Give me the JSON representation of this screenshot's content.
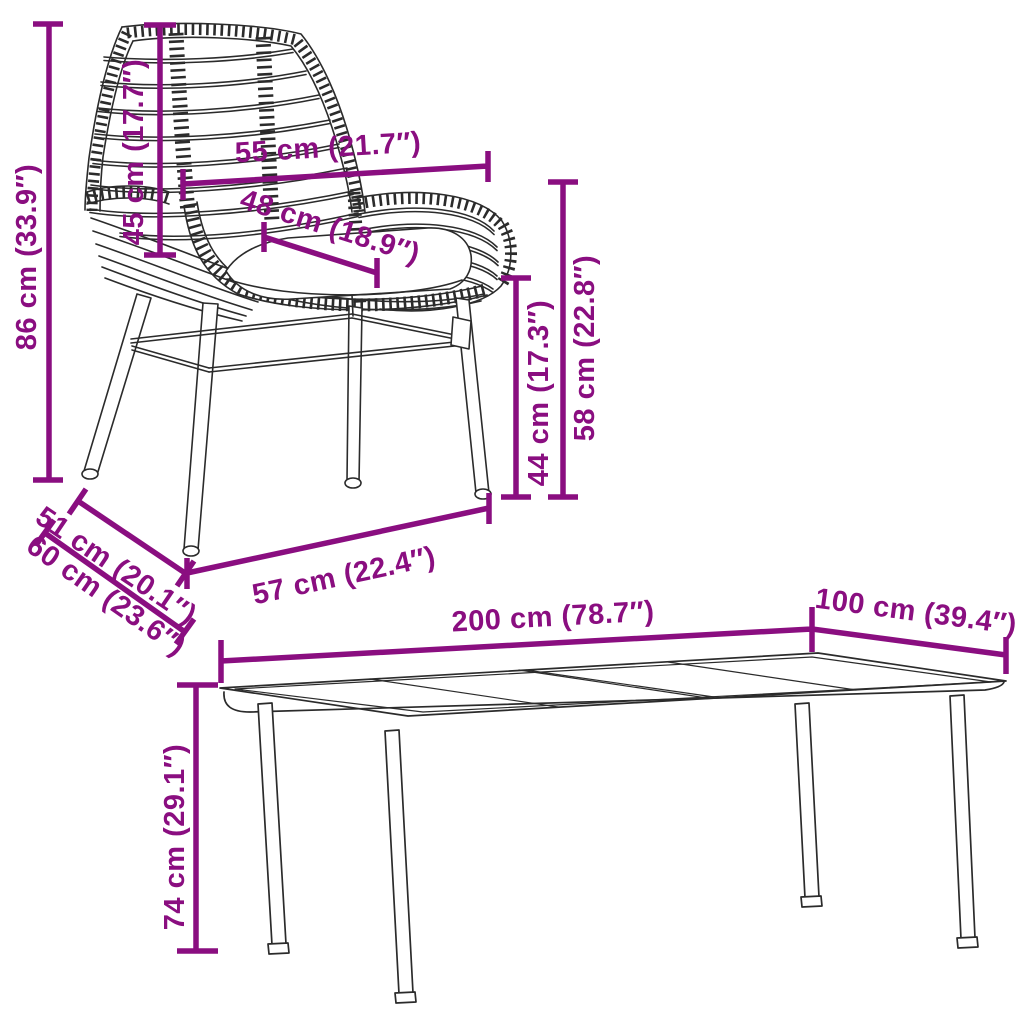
{
  "page": {
    "background": "#ffffff"
  },
  "colors": {
    "dimension_accent": "#8a0e80",
    "line_art": "#2b2b2b"
  },
  "chair": {
    "dims": {
      "total_height": "86 cm (33.9″)",
      "backrest_height": "45 cm (17.7″)",
      "back_width": "55 cm (21.7″)",
      "seat_depth": "48 cm (18.9″)",
      "seat_height": "44 cm (17.3″)",
      "armrest_height": "58 cm (22.8″)",
      "base_width": "57 cm (22.4″)",
      "base_depth_upper": "51 cm (20.1″)",
      "base_depth_lower": "60 cm (23.6″)"
    }
  },
  "table": {
    "dims": {
      "length": "200 cm (78.7″)",
      "width": "100 cm (39.4″)",
      "height": "74 cm (29.1″)"
    }
  }
}
